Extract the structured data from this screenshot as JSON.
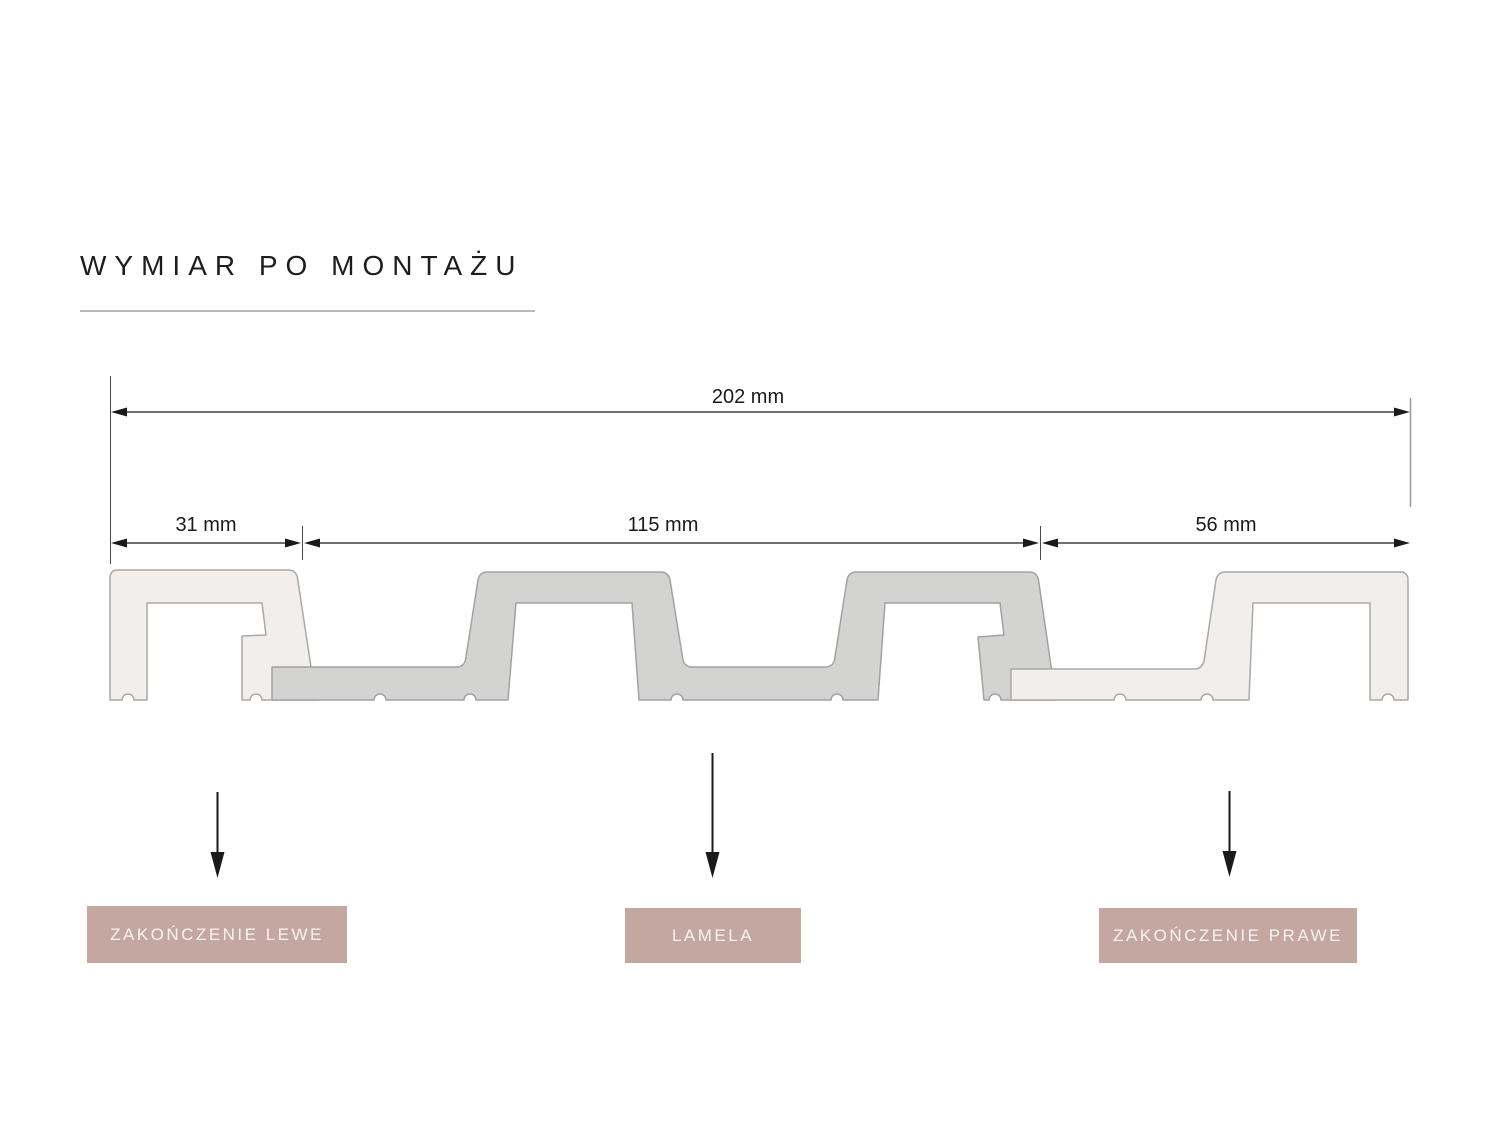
{
  "title": {
    "text": "WYMIAR PO MONTAŻU"
  },
  "dimensions": {
    "total": "202 mm",
    "left_ending": "31 mm",
    "lamela": "115 mm",
    "right_ending": "56 mm"
  },
  "labels": {
    "left_ending": "ZAKOŃCZENIE LEWE",
    "lamela": "LAMELA",
    "right_ending": "ZAKOŃCZENIE PRAWE"
  },
  "colors": {
    "cream": "#f2eeeb",
    "cream_stroke": "#aca8a5",
    "slat_gray": "#d3d3d2",
    "slat_stroke": "#a2a2a2",
    "rose": "#c4a7a0",
    "label_text": "#f7f4f2",
    "line_dark": "#1a1a1a",
    "ext_gray": "#9a9a9a",
    "title_color": "#1d1d1d",
    "underline_gray": "#b9b9b9"
  }
}
